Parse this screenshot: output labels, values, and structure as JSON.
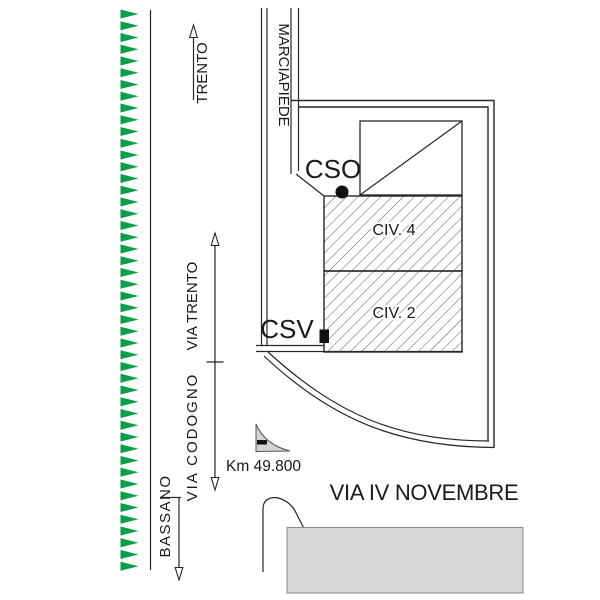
{
  "drawing": {
    "type": "site-plan",
    "labels": {
      "railway_dest_top": "TRENTO",
      "sidewalk": "MARCIAPIEDE",
      "street_vertical_1": "VIA TRENTO",
      "street_vertical_2": "VIA CODOGNO",
      "railway_dest_bottom": "BASSANO",
      "signal_cso": "CSO",
      "signal_csv": "CSV",
      "building_1": "CIV. 4",
      "building_2": "CIV. 2",
      "km_marker": "Km 49.800",
      "street_horizontal": "VIA IV NOVEMBRE"
    },
    "railway": {
      "tick_count": 48,
      "x_base": 120.5,
      "x_apex": 138.5,
      "y_start": 14,
      "spacing": 11.75,
      "half_height": 4.5,
      "color": "#0A9E49"
    },
    "colors": {
      "line": "#262626",
      "text": "#1a1a1a",
      "hatch": "#4a4a4a",
      "building_block_fill": "#D8D8D8",
      "km_marker_fill": "#D2D2D2",
      "railway_green": "#0A9E49"
    }
  }
}
